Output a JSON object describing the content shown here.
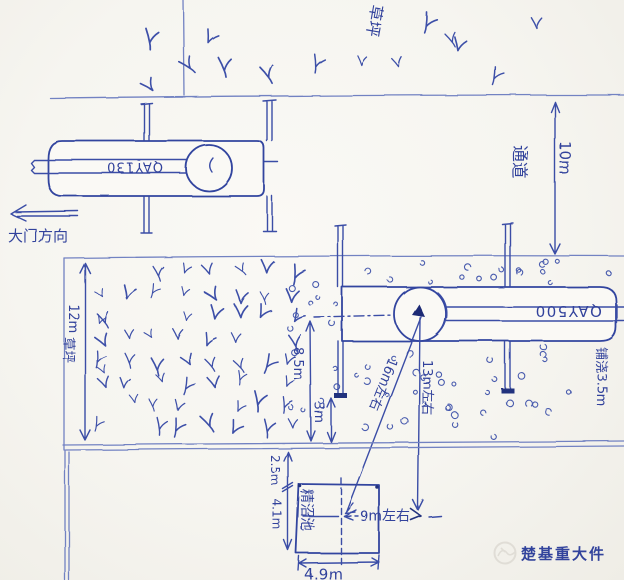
{
  "sketch": {
    "top_lawn": {
      "label": "草坪"
    },
    "gate": {
      "label": "大门方向"
    },
    "passage": {
      "label": "通道",
      "width": "10m"
    },
    "small_crane": {
      "model": "QAY130"
    },
    "large_crane": {
      "model": "QAY500"
    },
    "left_lawn": {
      "label": "草坪",
      "width": "12m"
    },
    "dims": {
      "center_to_edge": "8.5m",
      "outrigger_margin": "3m",
      "radius_to_pool": "16m左右",
      "offset_vertical": "13m左右",
      "offset_horizontal": "9m左右",
      "pool_setback": "2.5m",
      "pool_height": "4.1m",
      "pool_width": "4.9m"
    },
    "ground_note": "铺浇3.5m",
    "pool": {
      "label": "精沼池"
    },
    "watermark": {
      "text": "楚基重大件"
    }
  },
  "colors": {
    "ink": "#3a4da6",
    "ink_dark": "#22327e",
    "ruler_line": "#7282c2",
    "paper": "#f7f6f1",
    "watermark": "#e6e3dc"
  }
}
